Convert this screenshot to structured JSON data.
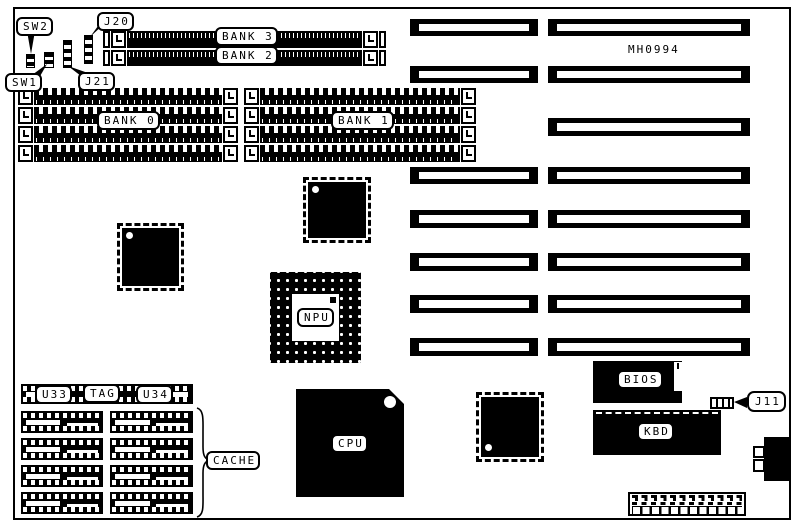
{
  "board": {
    "part_number": "MH0994",
    "labels": {
      "sw2": "SW2",
      "sw1": "SW1",
      "j20": "J20",
      "j21": "J21",
      "j11": "J11",
      "bank3": "BANK 3",
      "bank2": "BANK 2",
      "bank0": "BANK 0",
      "bank1": "BANK 1",
      "npu": "NPU",
      "cpu": "CPU",
      "bios": "BIOS",
      "kbd": "KBD",
      "u33": "U33",
      "tag": "TAG",
      "u34": "U34",
      "cache": "CACHE"
    }
  }
}
